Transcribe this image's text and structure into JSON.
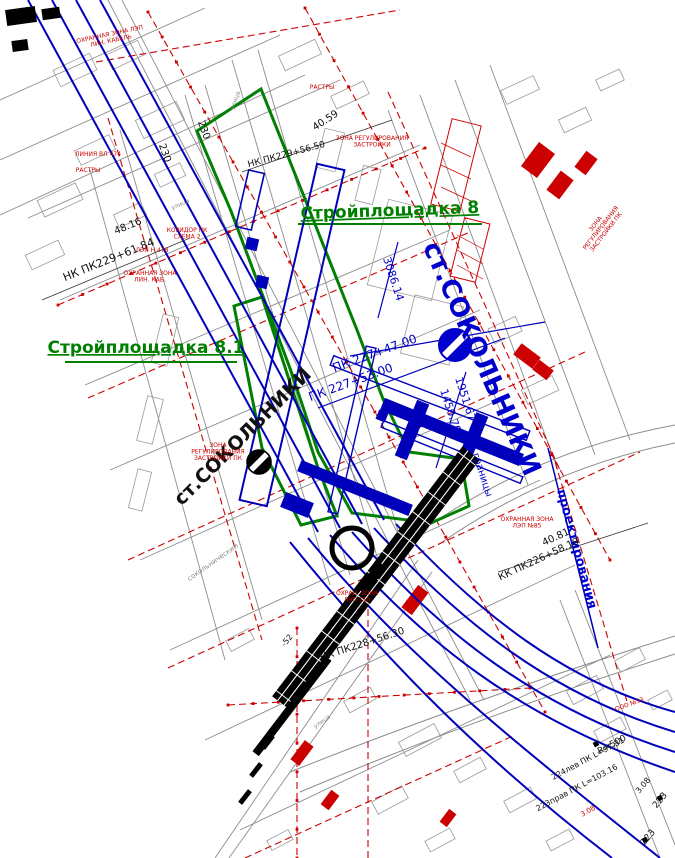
{
  "colors": {
    "metro_tunnel_blue": "#0000bb",
    "station_label_blue": "#0000cc",
    "construction_site_green": "#008000",
    "utility_zone_red": "#cc0000",
    "street_gray": "#777777",
    "rail_band_black": "#000000",
    "background": "#ffffff"
  },
  "labels": [
    {
      "name": "site-8-label",
      "text": "Стройплощадка 8",
      "x": 390,
      "y": 216,
      "rot": -2,
      "size": 17,
      "color": "green",
      "bold": true,
      "underline": true
    },
    {
      "name": "site-8-1-label",
      "text": "Стройплощадка 8.1",
      "x": 146,
      "y": 353,
      "rot": 0,
      "size": 17,
      "color": "green",
      "bold": true,
      "underline": true
    },
    {
      "name": "station-name-blue",
      "text": "ст.СОКОЛЬНИКИ",
      "x": 474,
      "y": 362,
      "rot": 66,
      "size": 26,
      "color": "blue",
      "bold": true
    },
    {
      "name": "station-name-black",
      "text": "ст.СОКОЛЬНИКИ",
      "x": 247,
      "y": 441,
      "rot": -45,
      "size": 19,
      "color": "black",
      "bold": true
    },
    {
      "name": "design-boundary-label",
      "text": "проектирования",
      "x": 573,
      "y": 550,
      "rot": 75,
      "size": 13,
      "color": "blue",
      "bold": true
    },
    {
      "name": "chainage-3086",
      "text": "3086.14",
      "x": 390,
      "y": 280,
      "rot": 72,
      "size": 11,
      "color": "blue"
    },
    {
      "name": "pk227-47",
      "text": "ПК 227+47.00",
      "x": 376,
      "y": 357,
      "rot": -20,
      "size": 12,
      "color": "blue"
    },
    {
      "name": "pk227-53",
      "text": "ПК 227+53.00",
      "x": 352,
      "y": 386,
      "rot": -20,
      "size": 12,
      "color": "blue"
    },
    {
      "name": "dist-1951",
      "text": "1951.67",
      "x": 462,
      "y": 400,
      "rot": 72,
      "size": 11,
      "color": "blue"
    },
    {
      "name": "dist-1450",
      "text": "1450.79",
      "x": 447,
      "y": 412,
      "rot": 72,
      "size": 11,
      "color": "blue"
    },
    {
      "name": "to-boundary-label",
      "text": "до границы",
      "x": 477,
      "y": 468,
      "rot": 72,
      "size": 10,
      "color": "blue"
    },
    {
      "name": "elev-48-16",
      "text": "48.16",
      "x": 129,
      "y": 229,
      "rot": -22,
      "size": 10,
      "color": "black"
    },
    {
      "name": "nk-pk229-61",
      "text": "НК ПК229+61.84",
      "x": 110,
      "y": 263,
      "rot": -22,
      "size": 11,
      "color": "black"
    },
    {
      "name": "elev-40-59",
      "text": "40.59",
      "x": 327,
      "y": 123,
      "rot": -33,
      "size": 10,
      "color": "black"
    },
    {
      "name": "nk-pk229-56",
      "text": "НК ПК229+56.50",
      "x": 287,
      "y": 157,
      "rot": -15,
      "size": 9,
      "color": "black"
    },
    {
      "name": "elev-40-81",
      "text": "40.81",
      "x": 557,
      "y": 540,
      "rot": -25,
      "size": 10,
      "color": "black"
    },
    {
      "name": "kk-pk226-58",
      "text": "КК ПК226+58.19",
      "x": 540,
      "y": 562,
      "rot": -25,
      "size": 10,
      "color": "black"
    },
    {
      "name": "nk-pk228-56",
      "text": "НК ПК228+56.30",
      "x": 363,
      "y": 647,
      "rot": -18,
      "size": 10,
      "color": "black"
    },
    {
      "name": "pk-230-a",
      "text": "230",
      "x": 162,
      "y": 154,
      "rot": 70,
      "size": 10,
      "color": "black"
    },
    {
      "name": "pk-230-b",
      "text": "230",
      "x": 201,
      "y": 131,
      "rot": 70,
      "size": 10,
      "color": "black"
    },
    {
      "name": "mark-minus52",
      "text": "-52",
      "x": 289,
      "y": 642,
      "rot": -50,
      "size": 8,
      "color": "black"
    },
    {
      "name": "curve-radius",
      "text": "R=500",
      "x": 613,
      "y": 747,
      "rot": -28,
      "size": 9,
      "color": "black"
    },
    {
      "name": "curve-224",
      "text": "224лев ПК L=97.31",
      "x": 589,
      "y": 761,
      "rot": -28,
      "size": 8,
      "color": "black"
    },
    {
      "name": "curve-223",
      "text": "223прав ПК L=103.16",
      "x": 578,
      "y": 790,
      "rot": -28,
      "size": 8,
      "color": "black"
    },
    {
      "name": "pk-223-a",
      "text": "223",
      "x": 662,
      "y": 802,
      "rot": -50,
      "size": 9,
      "color": "black"
    },
    {
      "name": "pk-223-b",
      "text": "223",
      "x": 650,
      "y": 839,
      "rot": -50,
      "size": 9,
      "color": "black"
    },
    {
      "name": "mark-3-08",
      "text": "3.08",
      "x": 645,
      "y": 787,
      "rot": -50,
      "size": 8,
      "color": "black"
    },
    {
      "name": "zone-reg-left",
      "lines": [
        "ЗОНА",
        "РЕГУЛИРОВАНИЯ",
        "ЗАСТРОЙКИ ПК"
      ],
      "x": 218,
      "y": 447,
      "rot": 0,
      "size": 6,
      "color": "red"
    },
    {
      "name": "zone-reg-right",
      "lines": [
        "ЗОНА",
        "РЕГУЛИРОВАНИЯ",
        "ЗАСТРОЙКИ ПК"
      ],
      "x": 597,
      "y": 225,
      "rot": -52,
      "size": 6,
      "color": "red"
    },
    {
      "name": "zone-reg-mid",
      "lines": [
        "ЗОНА РЕГУЛИРОВАНИЯ",
        "ЗАСТРОЙКИ"
      ],
      "x": 372,
      "y": 140,
      "rot": 0,
      "size": 6,
      "color": "red"
    },
    {
      "name": "zone-lep-topleft",
      "lines": [
        "ОХРАННАЯ ЗОНА ЛЭП",
        "ЛИН. КАБЕЛЬ"
      ],
      "x": 110,
      "y": 36,
      "rot": -12,
      "size": 6,
      "color": "red"
    },
    {
      "name": "lep-478",
      "text": "ЛЭП Н 478",
      "x": 152,
      "y": 252,
      "rot": 0,
      "size": 6,
      "color": "red"
    },
    {
      "name": "zone-lin-kab",
      "lines": [
        "ОХРАННАЯ ЗОНА",
        "ЛИН. КАБ."
      ],
      "x": 150,
      "y": 275,
      "rot": 0,
      "size": 6,
      "color": "red"
    },
    {
      "name": "koridor-pk",
      "lines": [
        "КОРИДОР ПК",
        "СХЕМА 2"
      ],
      "x": 187,
      "y": 232,
      "rot": 0,
      "size": 6,
      "color": "red"
    },
    {
      "name": "rastry-1",
      "text": "РАСТРЫ",
      "x": 88,
      "y": 172,
      "rot": 0,
      "size": 6,
      "color": "red"
    },
    {
      "name": "vl-474",
      "text": "ЛИНИЯ ВЛ 474",
      "x": 98,
      "y": 156,
      "rot": 0,
      "size": 6,
      "color": "red"
    },
    {
      "name": "zone-lep-85",
      "lines": [
        "ОХРАННАЯ ЗОНА",
        "ЛЭП №85"
      ],
      "x": 527,
      "y": 521,
      "rot": 0,
      "size": 6,
      "color": "red"
    },
    {
      "name": "ooo-53",
      "text": "ООО №53",
      "x": 630,
      "y": 706,
      "rot": -20,
      "size": 6,
      "color": "red"
    },
    {
      "name": "red-3-08",
      "text": "3.08",
      "x": 589,
      "y": 813,
      "rot": -30,
      "size": 7,
      "color": "red"
    },
    {
      "name": "zone-lep-110",
      "lines": [
        "ОХРАН. ЗОНА",
        "ЛЭП 110"
      ],
      "x": 357,
      "y": 595,
      "rot": 0,
      "size": 6,
      "color": "red"
    },
    {
      "name": "rastry-2",
      "text": "РАСТРЫ",
      "x": 322,
      "y": 89,
      "rot": 0,
      "size": 6,
      "color": "red"
    },
    {
      "name": "street-sokolnichesky",
      "text": "сокольнический",
      "x": 214,
      "y": 564,
      "rot": -35,
      "size": 7,
      "color": "gray"
    },
    {
      "name": "street-ulitsa-1",
      "text": "улица",
      "x": 237,
      "y": 101,
      "rot": -70,
      "size": 6,
      "color": "gray"
    },
    {
      "name": "street-ulitsa-2",
      "text": "улица",
      "x": 181,
      "y": 206,
      "rot": -24,
      "size": 6,
      "color": "gray"
    },
    {
      "name": "street-ulitsa-3",
      "text": "улица",
      "x": 323,
      "y": 723,
      "rot": -35,
      "size": 6,
      "color": "gray"
    }
  ]
}
